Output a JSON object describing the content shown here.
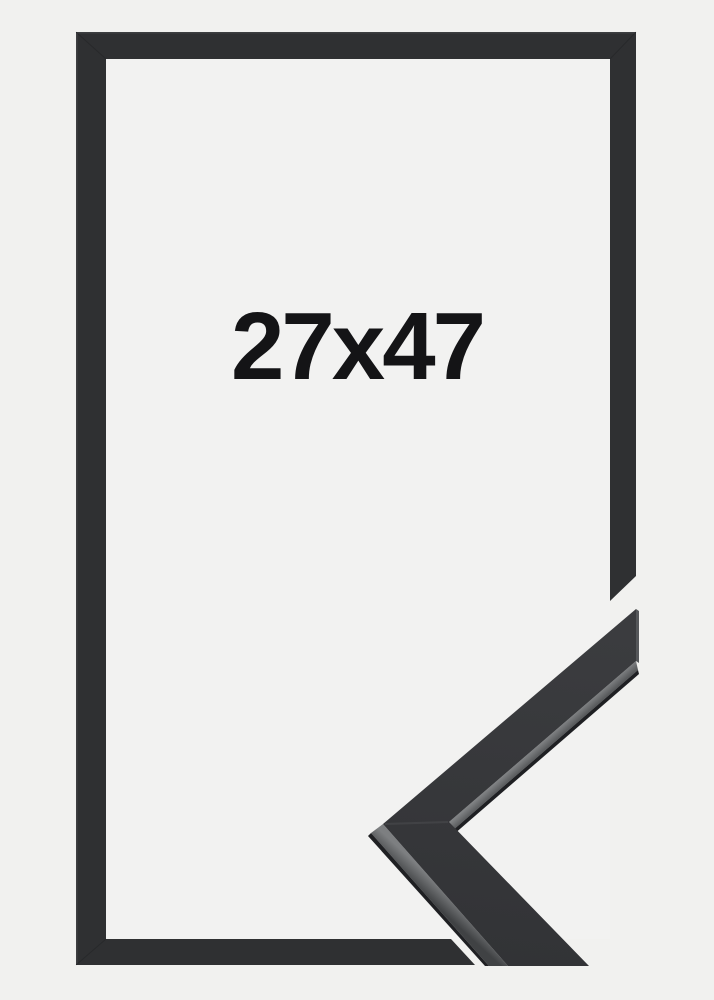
{
  "product": {
    "size_label": "27x47"
  },
  "colors": {
    "background": "#f1f1ef",
    "interior": "#f2f2f1",
    "frame": "#2f3032",
    "frame_highlight": "#414245",
    "seam": "#0f1012",
    "sample_face_top": "#3b3c3f",
    "sample_face_bottom": "#323336",
    "sample_bevel_light": "#7d7f81",
    "sample_bevel_dark": "#404244",
    "sample_edge": "#1f2023",
    "sample_tip_edge": "#55575a",
    "label_text": "#141416"
  }
}
